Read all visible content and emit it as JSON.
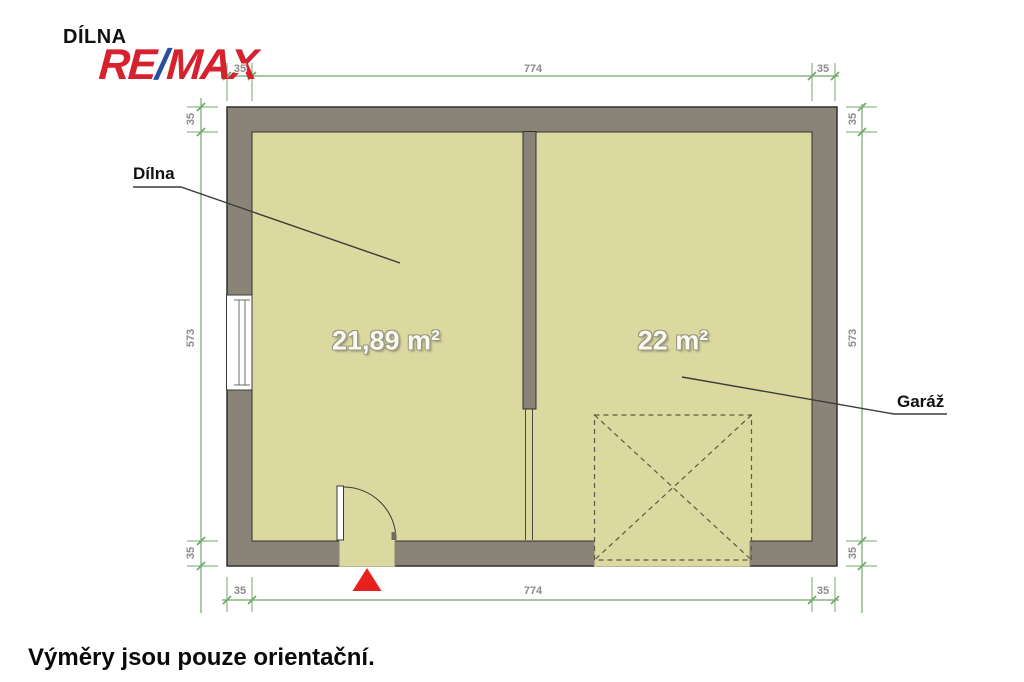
{
  "header": {
    "project_label": "DÍLNA",
    "logo": {
      "re": "RE",
      "slash": "/",
      "max": "MAX"
    }
  },
  "plan": {
    "rooms": [
      {
        "name": "Dílna",
        "area": "21,89 m²"
      },
      {
        "name": "Garáž",
        "area": "22 m²"
      }
    ],
    "dimensions": {
      "top": [
        "35",
        "774",
        "35"
      ],
      "bottom": [
        "35",
        "774",
        "35"
      ],
      "left": [
        "35",
        "573",
        "35"
      ],
      "right": [
        "35",
        "573",
        "35"
      ]
    },
    "colors": {
      "wall": "#8a8478",
      "floor": "#dbd8a0",
      "outline": "#31302b",
      "dimension_line": "#70a96b",
      "dimension_text": "#8c8c8c",
      "entrance_marker": "#e7211c",
      "logo_red": "#d6212e",
      "logo_blue": "#2b4ea5"
    }
  },
  "footer": {
    "disclaimer": "Výměry jsou pouze orientační."
  }
}
